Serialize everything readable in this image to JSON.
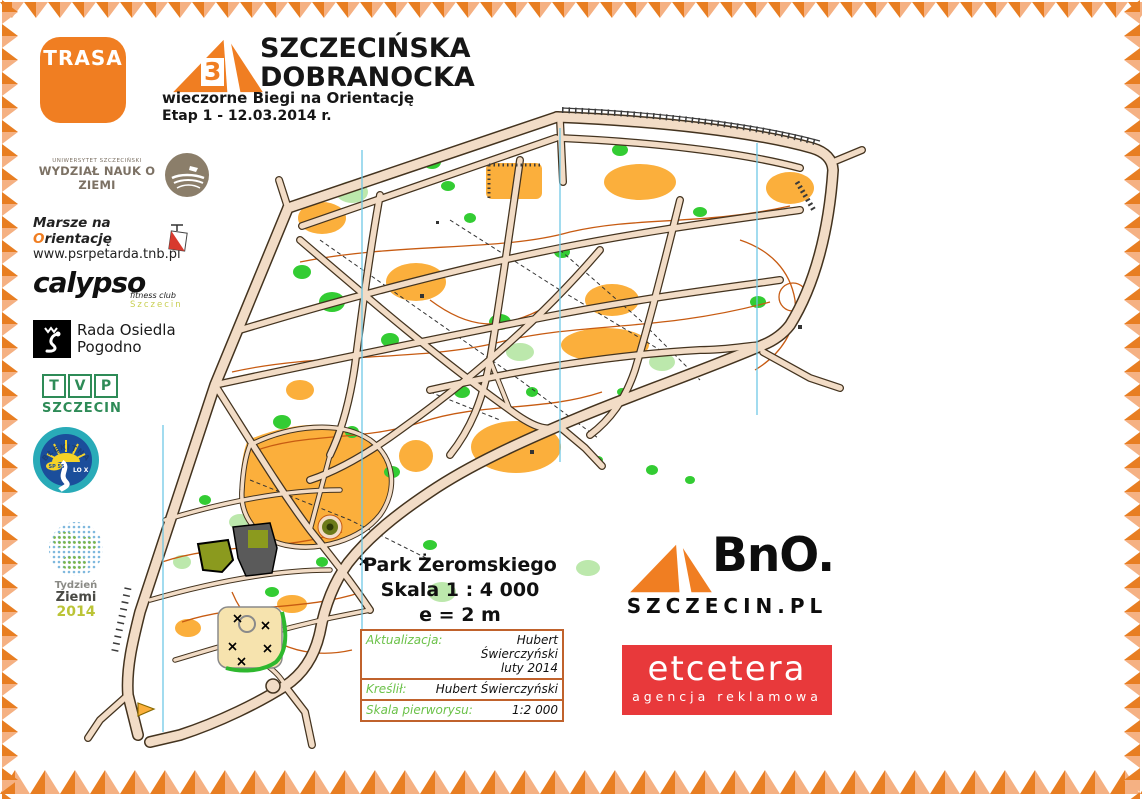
{
  "trasa_badge": {
    "label": "TRASA"
  },
  "header": {
    "logo_number": "3",
    "title_line1": "SZCZECIŃSKA",
    "title_line2": "DOBRANOCKA",
    "subtitle": "wieczorne Biegi na Orientację",
    "stage": "Etap 1 - 12.03.2014 r."
  },
  "sponsors": {
    "university": {
      "small": "UNIWERSYTET SZCZECIŃSKI",
      "name": "WYDZIAŁ NAUK O ZIEMI"
    },
    "marsze": {
      "line1_pre": "Marsze na ",
      "line1_o": "O",
      "line1_post": "rientację",
      "line2": "www.psrpetarda.tnb.pl"
    },
    "calypso": {
      "name": "calypso",
      "sub1": "fitness club",
      "sub2": "Szczecin"
    },
    "rada": {
      "line1": "Rada Osiedla",
      "line2": "Pogodno"
    },
    "tvp": {
      "letters": [
        "T",
        "V",
        "P"
      ],
      "city": "SZCZECIN"
    },
    "blekitna": {
      "top": "BŁĘKITNA",
      "left": "SP 55",
      "right": "LO X"
    },
    "tydzien": {
      "line1": "Tydzień",
      "line2": "Ziemi",
      "line3": "2014"
    }
  },
  "map_info": {
    "park_name": "Park Żeromskiego",
    "scale": "Skala 1 : 4 000",
    "contour": "e = 2 m"
  },
  "credits_table": {
    "rows": [
      {
        "label": "Aktualizacja:",
        "value": "Hubert Świerczyński",
        "value2": "luty 2014"
      },
      {
        "label": "Kreślił:",
        "value": "Hubert Świerczyński"
      },
      {
        "label": "Skala pierworysu:",
        "value": "1:2 000"
      }
    ]
  },
  "bno": {
    "name": "BnO.",
    "domain": "SZCZECIN.PL"
  },
  "etcetera": {
    "name": "etcetera",
    "sub": "agencja reklamowa"
  },
  "map_colors": {
    "road_fill": "#F2DCC6",
    "road_casing": "#43331F",
    "rough_open": "#FBAF3C",
    "vegetation_green": "#33CC33",
    "vegetation_light": "#BCE8AC",
    "contour": "#C75B12",
    "north_line": "#6CC7E6",
    "building": "#5A5A5A",
    "olive_area": "#8B9A1E",
    "sand_area": "#F6E3AE",
    "brand_orange": "#F07E22",
    "etcetera_red": "#E8393B"
  }
}
